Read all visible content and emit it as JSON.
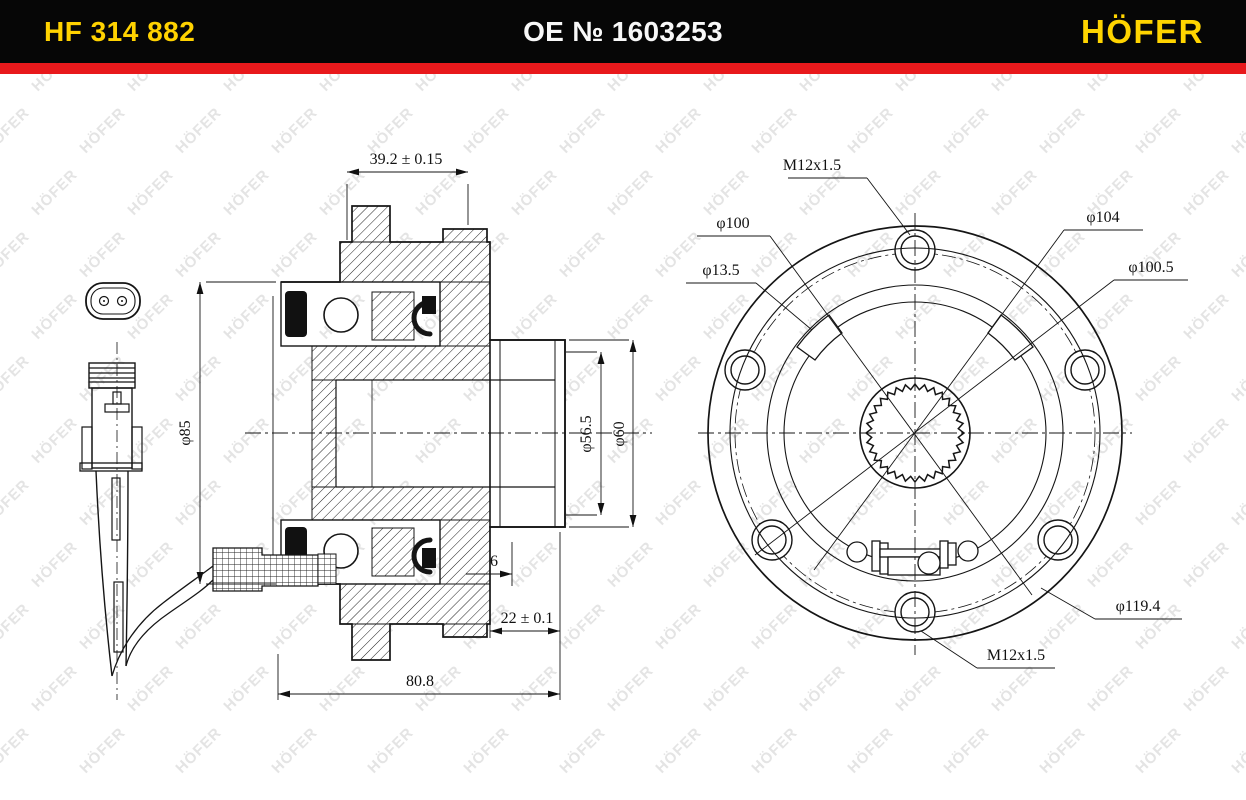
{
  "header": {
    "part_number": "HF 314 882",
    "oe_number": "OE № 1603253",
    "brand": "HÖFER",
    "colors": {
      "bar": "#060606",
      "stripe": "#e8191c",
      "accent_yellow": "#ffd200",
      "text_white": "#f8f8f8"
    }
  },
  "watermark": {
    "text": "HÖFER",
    "color": "#e4e4e4"
  },
  "drawing": {
    "line_color": "#151515",
    "left_view": {
      "title": "hub bearing cross-section with ABS sensor",
      "dims": {
        "top_width": "39.2 ± 0.15",
        "dia85": "φ85",
        "dia56_5": "φ56.5",
        "dia60": "φ60",
        "step6": "6",
        "depth22": "22 ± 0.1",
        "total_width": "80.8"
      }
    },
    "right_view": {
      "title": "hub flange front view",
      "dims": {
        "thread_top": "M12x1.5",
        "dia100": "φ100",
        "dia13_5": "φ13.5",
        "dia104": "φ104",
        "dia100_5": "φ100.5",
        "dia119_4": "φ119.4",
        "thread_bottom": "M12x1.5"
      }
    }
  }
}
